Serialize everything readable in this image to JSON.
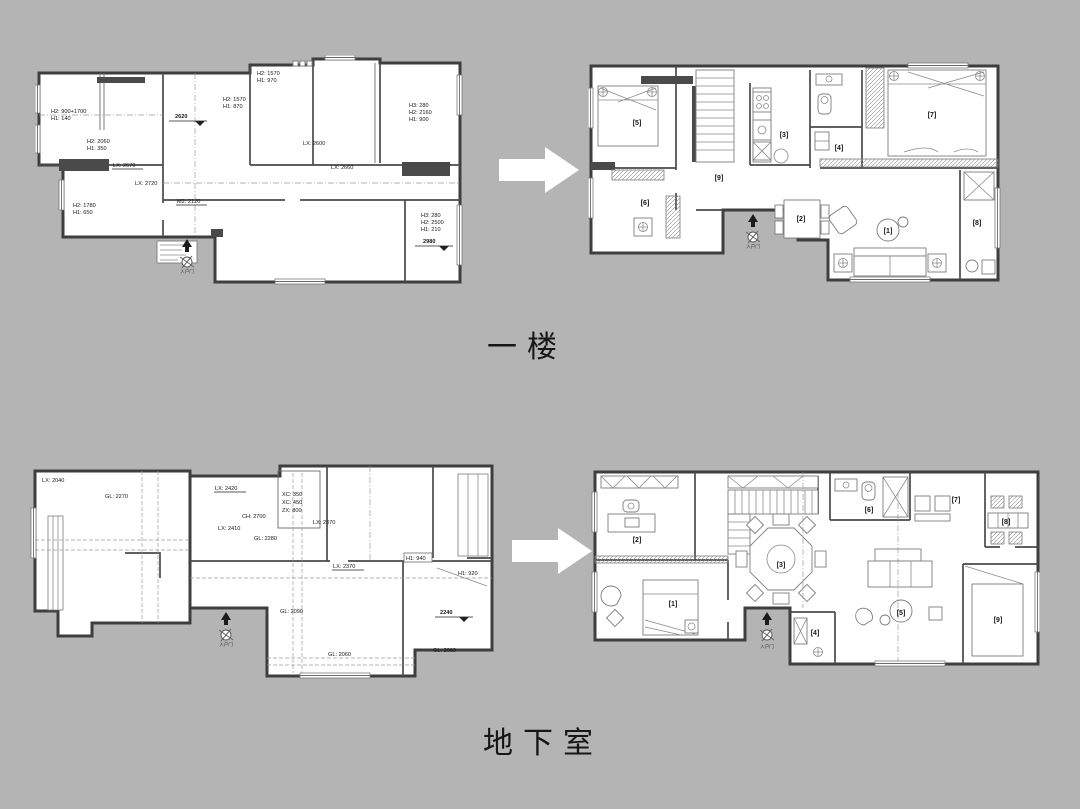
{
  "page": {
    "background_color": "#b4b4b4",
    "plan_paper_color": "#ffffff",
    "wall_color": "#454545",
    "arrow_color": "#ffffff"
  },
  "section_labels": {
    "first_floor": "一楼",
    "basement": "地下室"
  },
  "first_floor": {
    "measured_plan": {
      "labels": {
        "h_left_top_1": "H2: 900+1700",
        "h_left_top_2": "H1: 140",
        "h_left_mid_1": "H2: 2060",
        "h_left_mid_2": "H1: 350",
        "level_mid": "2620",
        "h_top_1": "H2: 1570",
        "h_top_2": "H1: 970",
        "h_mid_1": "H2: 1570",
        "h_mid_2": "H1: 870",
        "lx_2600": "LX: 2600",
        "lx_2660": "LX: 2660",
        "h_right_1": "H3: 280",
        "h_right_2": "H2: 2160",
        "h_right_3": "H1: 900",
        "h_right_low_1": "H3: 280",
        "h_right_low_2": "H2: 2500",
        "h_right_low_3": "H1: 210",
        "level_right": "2980",
        "lx_2670": "LX: 2670",
        "lx_2720": "LX: 2720",
        "m2_2120": "M2: 2120",
        "h_bottom_1": "H2: 1780",
        "h_bottom_2": "H1: 650",
        "entry": "入户门"
      }
    },
    "layout_plan": {
      "rooms": {
        "r1": "[1]",
        "r2": "[2]",
        "r3": "[3]",
        "r4": "[4]",
        "r5": "[5]",
        "r6": "[6]",
        "r7": "[7]",
        "r8": "[8]",
        "r9": "[9]"
      },
      "entry": "入户门"
    }
  },
  "basement": {
    "measured_plan": {
      "labels": {
        "lx_2040": "LX: 2040",
        "gl_2270": "GL: 2270",
        "lx_2420": "LX: 2420",
        "ch_2700": "CH: 2700",
        "lx_2410": "LX: 2410",
        "gl_2280": "GL: 2280",
        "xc_350": "XC: 350",
        "xc_450": "XC: 450",
        "zx_800": "ZX: 800",
        "lx_2370_a": "LX: 2370",
        "lx_2370_b": "LX: 2370",
        "h1_940": "H1: 940",
        "h1_920": "H1: 920",
        "gl_2090": "GL: 2090",
        "level": "2240",
        "gl_2060_a": "GL: 2060",
        "gl_2060_b": "GL: 2060",
        "entry": "入户门"
      }
    },
    "layout_plan": {
      "rooms": {
        "r1": "[1]",
        "r2": "[2]",
        "r3": "[3]",
        "r4": "[4]",
        "r5": "[5]",
        "r6": "[6]",
        "r7": "[7]",
        "r8": "[8]",
        "r9": "[9]"
      },
      "entry": "入户门"
    }
  }
}
